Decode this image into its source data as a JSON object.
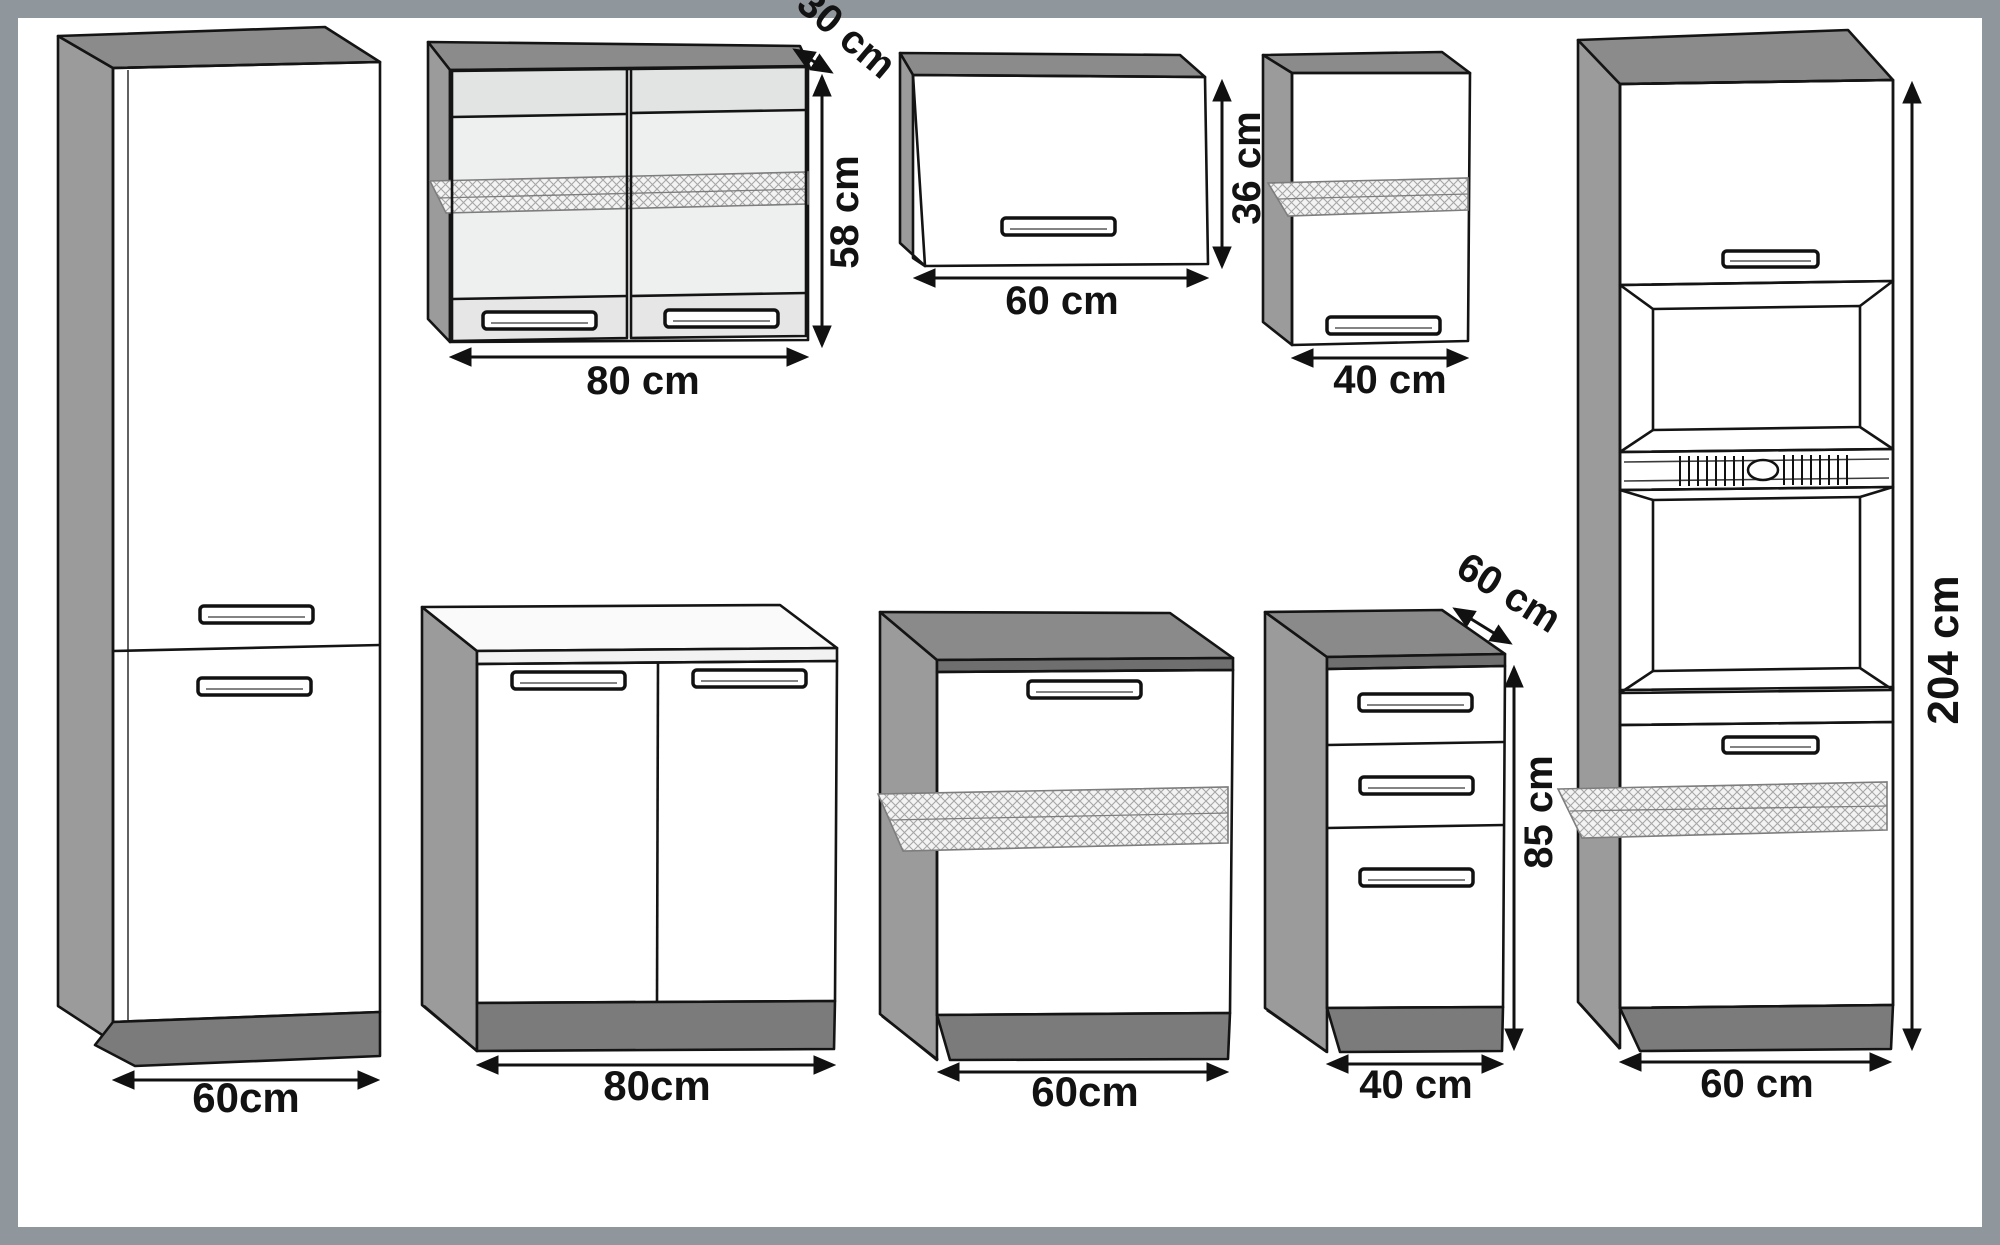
{
  "figure": {
    "description": "Technical line drawing of a kitchen cabinet set: eight modules shown in 3D outline with dimension arrows",
    "units": "cm"
  },
  "colors": {
    "frame_border": "#90979c",
    "canvas": "#ffffff",
    "cabinet_top": "#8b8b8b",
    "cabinet_side": "#9b9b9b",
    "plinth": "#7b7b7b",
    "front_light": "#ebebeb",
    "glass": "#eef0ef",
    "worktop_white": "#fafafa",
    "worktop_gray": "#8a8a8a",
    "outline": "#141414"
  },
  "cabinets": [
    {
      "name": "tall-cabinet-left",
      "width_label": "60cm"
    },
    {
      "name": "wall-cabinet-glass-doors",
      "width_label": "80 cm",
      "height_label": "58 cm",
      "depth_label": "30 cm"
    },
    {
      "name": "wall-cabinet-flap",
      "width_label": "60 cm",
      "height_label": "36 cm"
    },
    {
      "name": "wall-cabinet-one-door",
      "width_label": "40 cm"
    },
    {
      "name": "base-cabinet-two-doors",
      "width_label": "80cm"
    },
    {
      "name": "base-cabinet-one-door",
      "width_label": "60cm"
    },
    {
      "name": "drawer-cabinet",
      "width_label": "40 cm",
      "height_label": "85 cm",
      "depth_label": "60 cm"
    },
    {
      "name": "oven-housing-cabinet",
      "width_label": "60 cm",
      "height_label": "204 cm"
    }
  ]
}
